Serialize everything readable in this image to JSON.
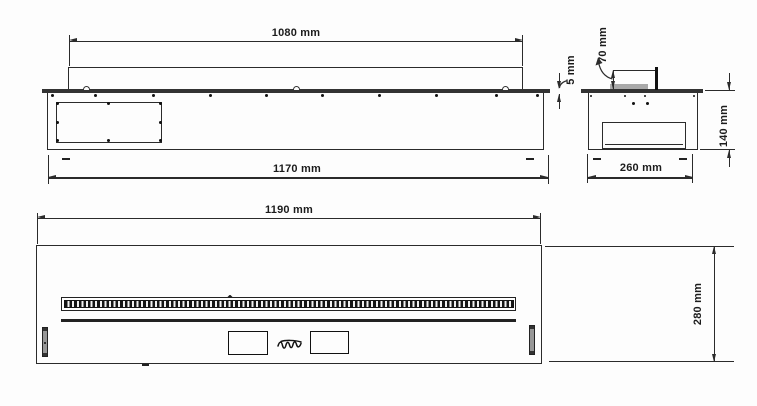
{
  "drawing": {
    "type": "technical-dimension-drawing",
    "views": {
      "side": {
        "dims": {
          "tray_width": "1080 mm",
          "body_width": "1170 mm"
        }
      },
      "end": {
        "dims": {
          "flange_thickness": "5 mm",
          "burner_slot_width": "70 mm",
          "body_height": "140 mm",
          "body_depth": "260 mm"
        }
      },
      "front": {
        "dims": {
          "fascia_width": "1190 mm",
          "fascia_height": "280 mm"
        }
      }
    },
    "icons": {
      "brand_logo": "cursive-signature-mark"
    },
    "colors": {
      "line": "#2b2b2b",
      "dark": "#111111",
      "flange_fill": "#333333",
      "tray_fill": "#a9a9a9",
      "slot_fill": "#8a8a8a",
      "background": "#fdfdfd"
    }
  }
}
